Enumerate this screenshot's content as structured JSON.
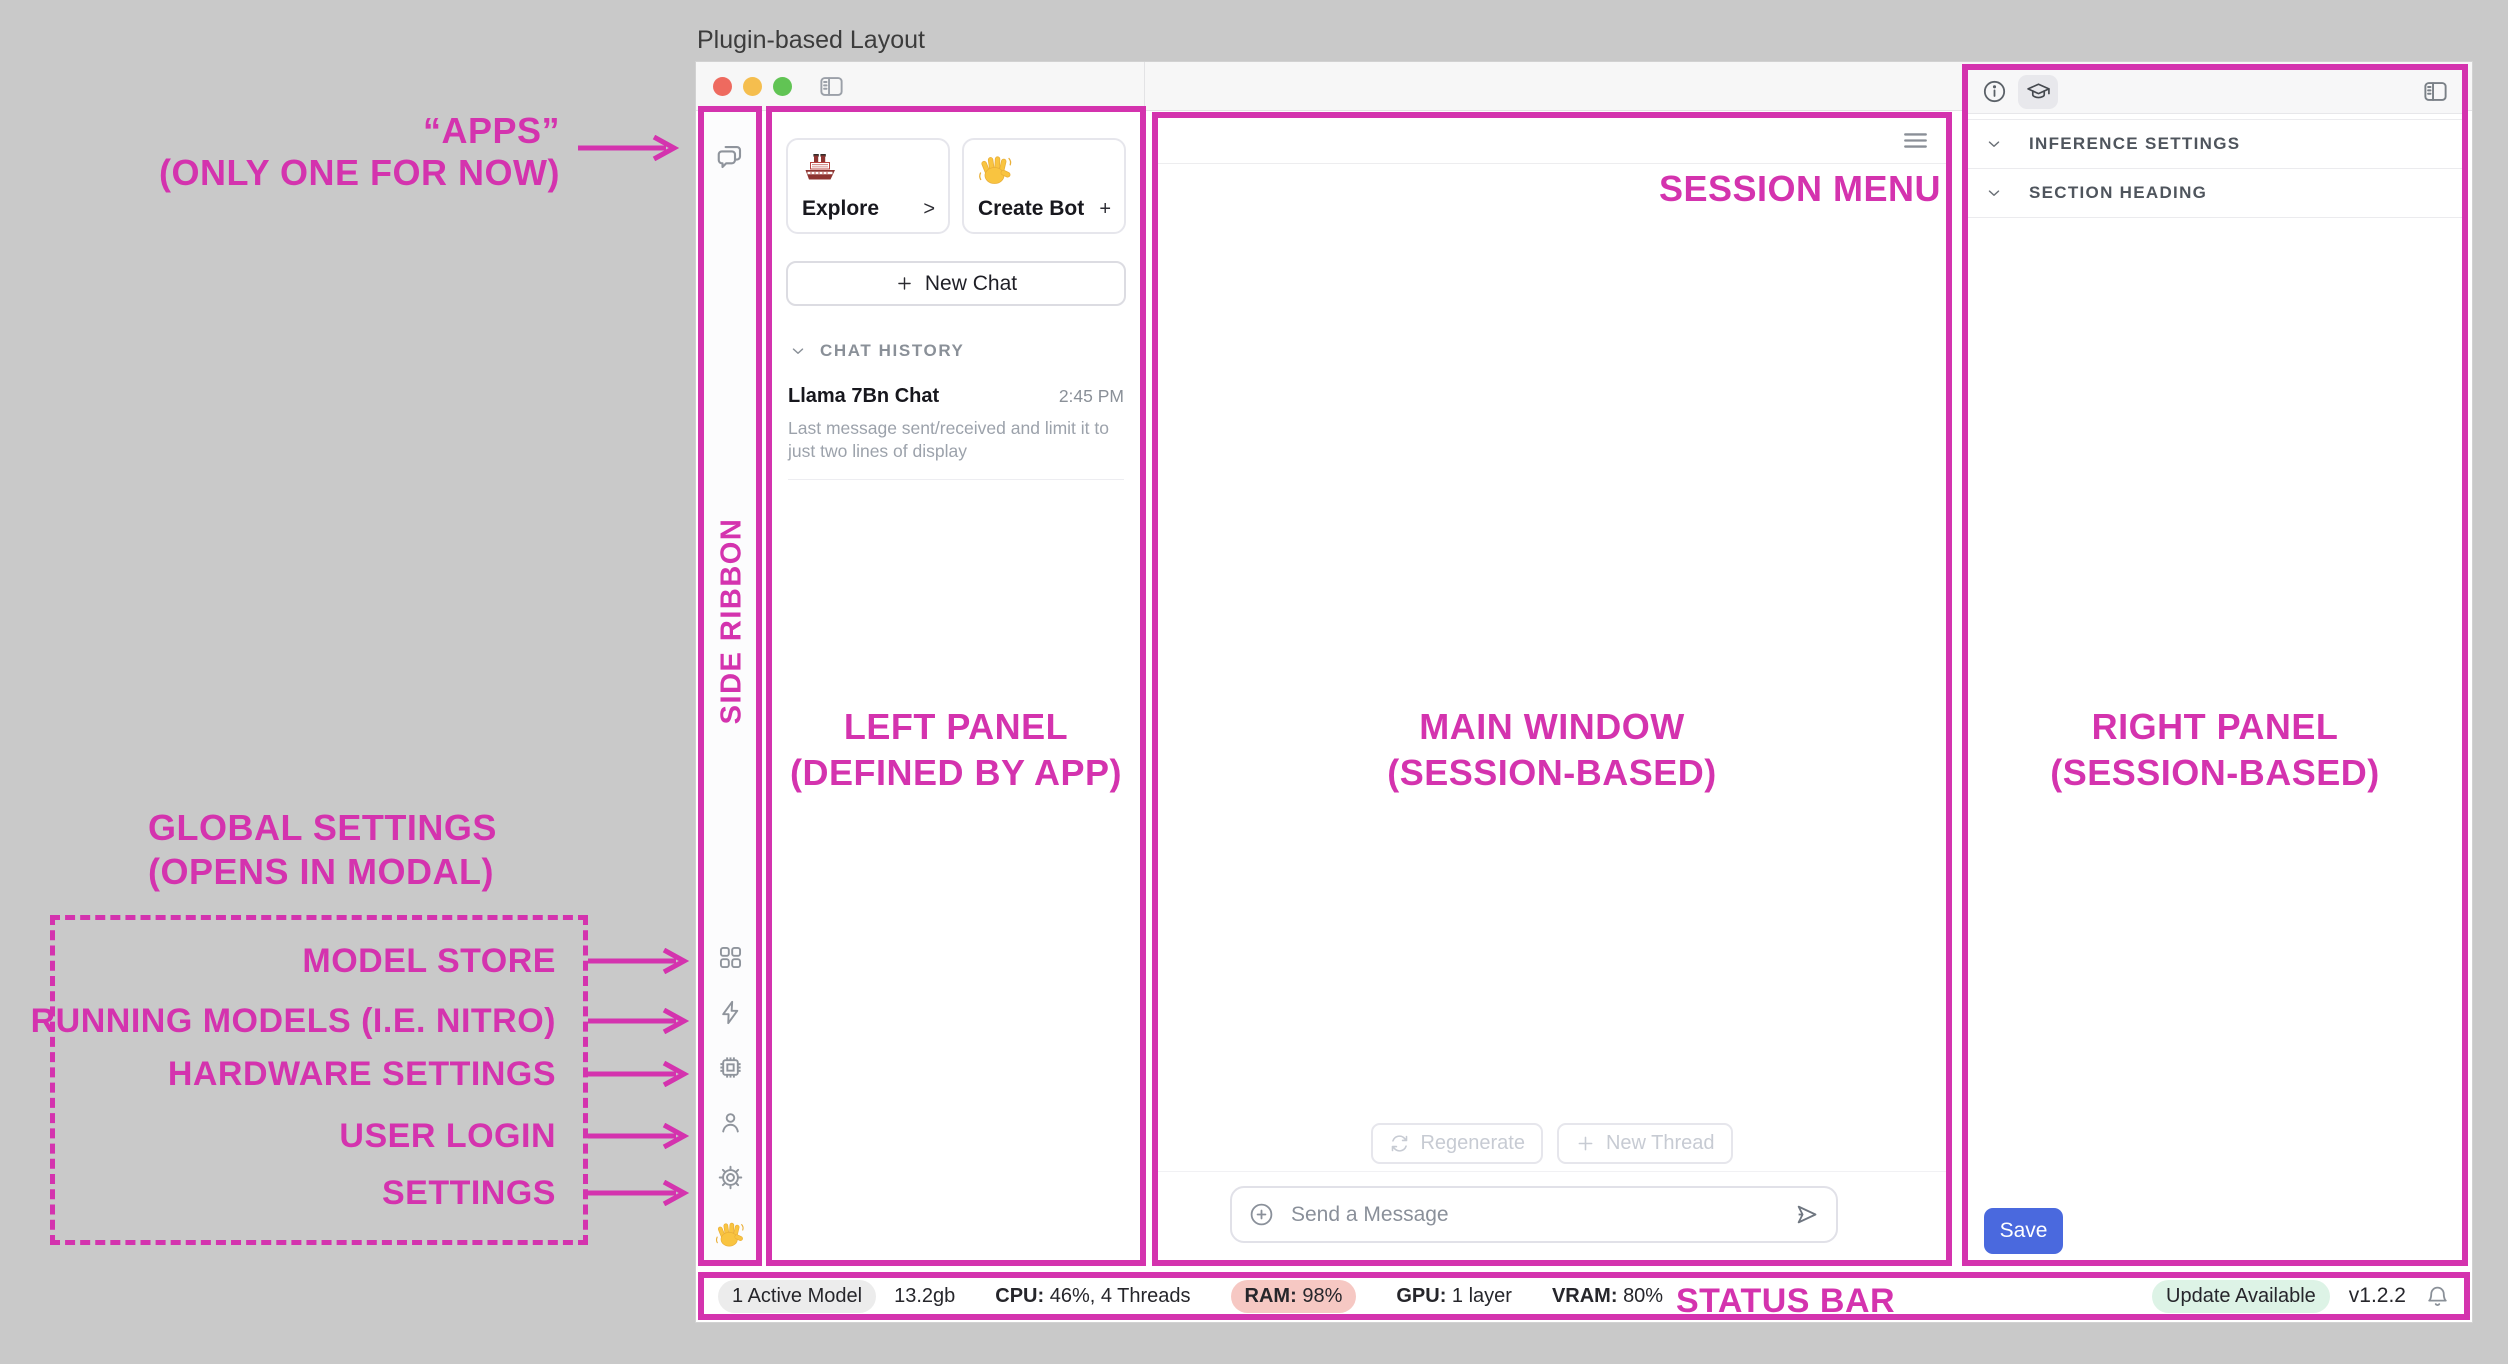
{
  "caption": "Plugin-based Layout",
  "colors": {
    "accent_annotation": "#D433AE",
    "save_button": "#4A69DE",
    "ram_badge": "#F6C8C3",
    "update_badge": "#DDF3E6",
    "active_model_badge": "#ECECEC",
    "traffic_red": "#EE6A5F",
    "traffic_yellow": "#F5BE4E",
    "traffic_green": "#61C454"
  },
  "left_panel": {
    "cards": [
      {
        "icon": "ship-emoji",
        "label": "Explore",
        "action": ">"
      },
      {
        "icon": "wave-emoji",
        "label": "Create Bot",
        "action": "+"
      }
    ],
    "new_chat_plus": "+",
    "new_chat_label": "New Chat",
    "history_header": "CHAT HISTORY",
    "chats": [
      {
        "title": "Llama 7Bn Chat",
        "time": "2:45 PM",
        "preview": "Last message sent/received and limit it to just two lines of display"
      }
    ]
  },
  "main": {
    "regenerate_label": "Regenerate",
    "new_thread_plus": "+",
    "new_thread_label": "New Thread",
    "message_placeholder": "Send a Message"
  },
  "right_panel": {
    "title": "MODEL SETTINGS",
    "sections": [
      {
        "label": "INFERENCE SETTINGS"
      },
      {
        "label": "SECTION HEADING"
      }
    ],
    "save_label": "Save"
  },
  "status_bar": {
    "active_model_badge": "1 Active Model",
    "memory": "13.2gb",
    "cpu_label": "CPU:",
    "cpu_value": "46%, 4 Threads",
    "ram_label": "RAM:",
    "ram_value": "98%",
    "gpu_label": "GPU:",
    "gpu_value": "1 layer",
    "vram_label": "VRAM:",
    "vram_value": "80%",
    "update_badge": "Update Available",
    "version": "v1.2.2"
  },
  "annotations": {
    "apps_line1": "“APPS”",
    "apps_line2": "(ONLY ONE FOR NOW)",
    "side_ribbon": "SIDE RIBBON",
    "left_panel_line1": "LEFT PANEL",
    "left_panel_line2": "(DEFINED BY APP)",
    "main_window_line1": "MAIN WINDOW",
    "main_window_line2": "(SESSION-BASED)",
    "right_panel_line1": "RIGHT PANEL",
    "right_panel_line2": "(SESSION-BASED)",
    "session_menu": "SESSION MENU",
    "status_bar": "STATUS BAR",
    "global_settings_line1": "GLOBAL SETTINGS",
    "global_settings_line2": "(OPENS IN MODAL)",
    "ribbon_items": [
      {
        "label": "MODEL STORE"
      },
      {
        "label": "RUNNING MODELS (I.E. NITRO)"
      },
      {
        "label": "HARDWARE SETTINGS"
      },
      {
        "label": "USER LOGIN"
      },
      {
        "label": "SETTINGS"
      }
    ]
  },
  "icons": {
    "apps_chat": "speech-bubbles",
    "model_store": "grid",
    "running_models": "lightning-bolt",
    "hardware_settings": "cpu-chip",
    "user_login": "person",
    "settings": "gear",
    "wave": "waving-hand",
    "explore": "ship",
    "info": "info-circle",
    "assistant": "graduation-cap",
    "panel_toggle": "sidebar-toggle",
    "session_menu": "hamburger-menu",
    "regenerate": "refresh-arrows",
    "attach": "plus-circle",
    "send": "paper-plane",
    "notifications": "bell",
    "collapse": "chevron-down"
  }
}
